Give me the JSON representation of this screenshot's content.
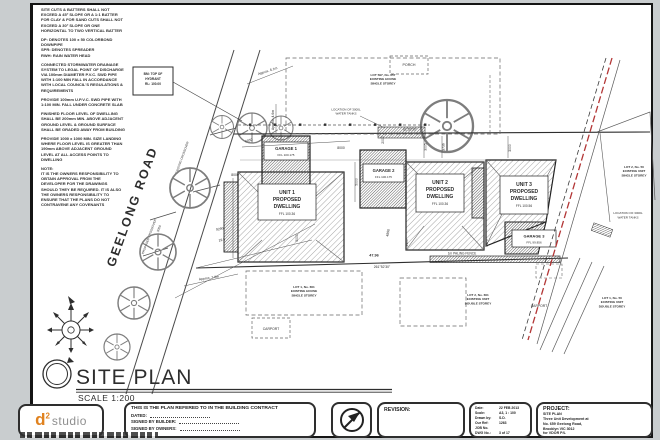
{
  "notes": [
    "SITE CUTS & BATTERS SHALL NOT EXCEED A 45° SLOPE OR A 1:1 BATTER FOR CLAY & FOR SAND CUTS SHALL NOT EXCEED A 30° SLOPE OR ONE HORIZONTAL TO TWO VERTICAL BATTER",
    "DP: DENOTES 100 x 50 COLORBOND DOWNPIPE\nSPR: DENOTES SPREADER\nRWH: RAIN WATER HEAD",
    "CONNECTED STORMWATER DRAINAGE SYSTEM TO LEGAL POINT OF DISCHARGE VIA 100mm DIAMETER P.V.C. SWD PIPE WITH 1:100 MIN FALL IN ACCORDANCE WITH LOCAL COUNCIL'S REGULATIONS & REQUIREMENTS",
    "PROVIDE 100mm U.P.V.C. SWD PIPE WITH 1:100 MIN. FALL UNDER CONCRETE SLAB",
    "FINISHED FLOOR LEVEL OF DWELLING SHALL BE 200mm MIN. ABOVE ADJACENT GROUND LEVEL & GROUND SURFACE SHALL BE GRADED AWAY FROM BUILDING",
    "PROVIDE 1000 x 1000 MIN. SIZE LANDING WHERE FLOOR LEVEL IS GREATER THAN 190mm ABOVE ADJACENT GROUND LEVEL AT ALL ACCESS POINTS TO DWELLING",
    "NOTE:\nIT IS THE OWNERS RESPONSIBILITY TO OBTAIN APPROVAL FROM THE DEVELOPER FOR THE DRAWINGS SHOULD THEY BE REQUIRED. IT IS ALSO THE OWNERS RESPONSIBILITY TO ENSURE THAT THE PLANS DO NOT CONTRAVENE ANY COVENANTS"
  ],
  "plan": {
    "road": "GEELONG ROAD",
    "existing_crossover": "EXISTING CROSSOVER",
    "proposed_crossover": "PROPOSED CROSSOVER",
    "porch": "PORCH",
    "paling_fence": "1m PALING FENCE",
    "carport": "CARPORT",
    "water_tanks": [
      "LOCATION OF 3000L",
      "WATER TANKS"
    ],
    "benchmark": [
      "BM: TOP OF",
      "HYDRANT",
      "RL: 100.00"
    ],
    "units": {
      "unit1": {
        "name": "UNIT 1",
        "l2": "PROPOSED",
        "l3": "DWELLING",
        "ffl": "FFL 100.36"
      },
      "unit2": {
        "name": "UNIT 2",
        "l2": "PROPOSED",
        "l3": "DWELLING",
        "ffl": "FFL 100.36"
      },
      "unit3": {
        "name": "UNIT 3",
        "l2": "PROPOSED",
        "l3": "DWELLING",
        "ffl": "FFL 100.56"
      },
      "garage1": {
        "name": "GARAGE 1",
        "ffl": "FFL 100.175"
      },
      "garage2": {
        "name": "GARAGE 2",
        "ffl": "FFL 100.175"
      },
      "garage3": {
        "name": "GARAGE 3",
        "ffl": "FFL 99.856"
      }
    },
    "neighbors": {
      "lot597": [
        "LOT 597, No. 657",
        "EXISTING HOUSE",
        "SINGLE STOREY"
      ],
      "lot1_661": [
        "LOT 1, No. 661",
        "EXISTING HOUSE",
        "SINGLE STOREY"
      ],
      "lot2_661": [
        "LOT 2, No. 661",
        "EXISTING UNIT",
        "DOUBLE STOREY"
      ],
      "lot1_50": [
        "LOT 1, No. 50",
        "EXISTING UNIT",
        "DOUBLE STOREY"
      ],
      "lot2_50": [
        "LOT 2, No. 50",
        "EXISTING UNIT",
        "SINGLE STOREY"
      ]
    },
    "dims": {
      "approx61": "Approx. 6.1m",
      "approx46": "Approx. 4.6m",
      "approx78": "Approx. 7.8m",
      "d8000a": "8000",
      "d8000b": "8000",
      "d6450": "6450",
      "d5000a": "5000",
      "d5000b": "5000",
      "d3005": "3005",
      "d3736": "3736",
      "d3000a": "3000",
      "d3000b": "3000",
      "d2000": "2000",
      "d9290": "9290",
      "d195": "19.5",
      "d3400": "3400",
      "d3470": "3470",
      "d4890": "4890",
      "len4796": "47.96",
      "brg261": "261°52'30\"",
      "brg81": "81°52'30\""
    }
  },
  "title": {
    "label": "SITE PLAN",
    "scale": "SCALE 1:200"
  },
  "titleblock": {
    "logo": {
      "mark": "d",
      "sup": "2",
      "name": "studio"
    },
    "contract": {
      "heading": "THIS IS THE PLAN REFERED TO IN THE BUILDING CONTRACT",
      "rows": [
        "DATED:",
        "SIGNED BY BUILDER:",
        "SIGNED BY OWNERS:"
      ]
    },
    "revision_label": "REVISION:",
    "info_rows": [
      [
        "Date:",
        "22 FEB 2013"
      ],
      [
        "Scale:",
        "A3, 1 : 100"
      ],
      [
        "Drawn by:",
        "S.D."
      ],
      [
        "Our Ref:",
        "1263"
      ],
      [
        "JOB No.",
        ""
      ],
      [
        "DWG No.:",
        "3 of 17"
      ]
    ],
    "project": {
      "heading": "PROJECT:",
      "lines": [
        "SITE PLAN",
        "Three Unit Development at",
        "No. 659 Geelong Road,",
        "Brooklyn VIC 3012",
        "for VDOR P/L"
      ]
    }
  }
}
